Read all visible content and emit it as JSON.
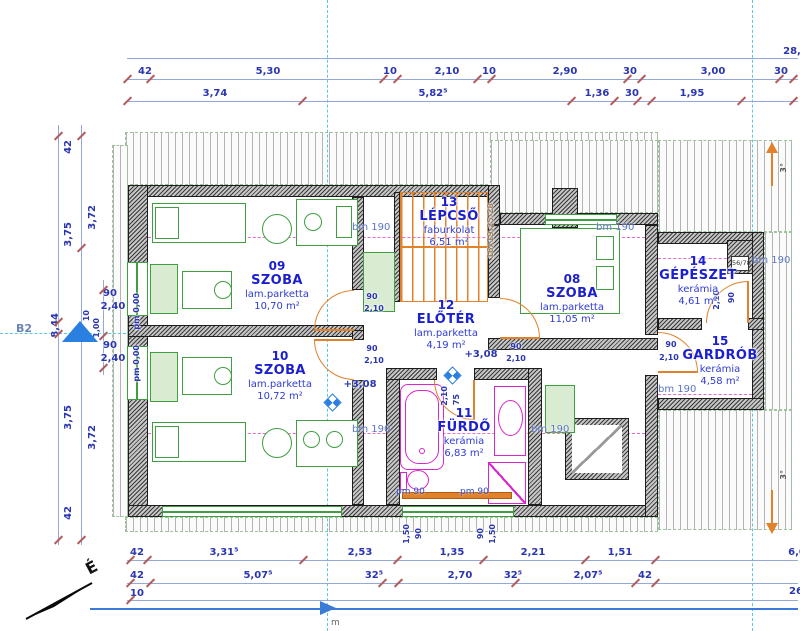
{
  "rooms": [
    {
      "id": "09",
      "name": "SZOBA",
      "finish": "lam.parketta",
      "area": "10,70 m²"
    },
    {
      "id": "10",
      "name": "SZOBA",
      "finish": "lam.parketta",
      "area": "10,72 m²"
    },
    {
      "id": "08",
      "name": "SZOBA",
      "finish": "lam.parketta",
      "area": "11,05 m²"
    },
    {
      "id": "11",
      "name": "FÜRDŐ",
      "finish": "kerámia",
      "area": "6,83 m²"
    },
    {
      "id": "12",
      "name": "ELŐTÉR",
      "finish": "lam.parketta",
      "area": "4,19 m²"
    },
    {
      "id": "13",
      "name": "LÉPCSŐ",
      "finish": "faburkolat",
      "area": "6,51 m²"
    },
    {
      "id": "14",
      "name": "GÉPÉSZET",
      "finish": "kerámia",
      "area": "4,61 m²"
    },
    {
      "id": "15",
      "name": "GARDRÓB",
      "finish": "kerámia",
      "area": "4,58 m²"
    }
  ],
  "dims": {
    "top1": [
      "42",
      "5,30",
      "10",
      "2,10",
      "10",
      "2,90",
      "30",
      "3,00",
      "30"
    ],
    "top2": [
      "3,74",
      "5,82⁵",
      "1,36",
      "30",
      "1,95"
    ],
    "bottom1": [
      "42",
      "3,31⁵",
      "2,53",
      "1,35",
      "2,21",
      "1,51"
    ],
    "bottom2": [
      "42",
      "5,07⁵",
      "32⁵",
      "2,70",
      "32⁵",
      "2,07⁵",
      "42"
    ],
    "bottom3": [
      "10"
    ],
    "edge": {
      "top": "28,",
      "mid": "6,0",
      "bot": "26"
    },
    "left": {
      "t42": "42",
      "i372t": "3,72",
      "o375t": "3,75",
      "win_w": "90",
      "win_h": "2,40",
      "d10": "10",
      "d100": "1,00",
      "total": "8,44",
      "o375b": "3,75",
      "i372b": "3,72",
      "b42": "42"
    },
    "bath": [
      "1,50",
      "90",
      "90",
      "1,50"
    ]
  },
  "doors": {
    "room09": {
      "w": "90",
      "h": "2,10"
    },
    "room10": {
      "w": "90",
      "h": "2,10"
    },
    "room08": {
      "w": "90",
      "h": "2,10"
    },
    "room11": {
      "w": "75",
      "h": "2,10"
    },
    "room14": {
      "w": "90",
      "h": "2,10"
    },
    "room15": {
      "w": "90",
      "h": "2,10"
    }
  },
  "annotations": {
    "bm190": "bm 190",
    "pm90": "pm 90",
    "pm000": "pm 0,00",
    "level": "+3,08",
    "stair_note": "16x19,25/28",
    "slope": "3°",
    "section": "B2",
    "north": "É",
    "meter": "m",
    "chimney": "56/78"
  },
  "colors": {
    "dim_line": "#93a9d9",
    "dim_text": "#2a35b0",
    "tick": "#b25b5b",
    "wall": "#3a3a3a",
    "door": "#e0812c",
    "furniture": "#3f9e3f",
    "furniture_fill": "#d9ecd2",
    "bath": "#d926cc",
    "axis": "#58c8e0",
    "level_marker": "#2a7fe0",
    "bm_label": "#5b74c4",
    "section_line": "#3b7bd8"
  }
}
